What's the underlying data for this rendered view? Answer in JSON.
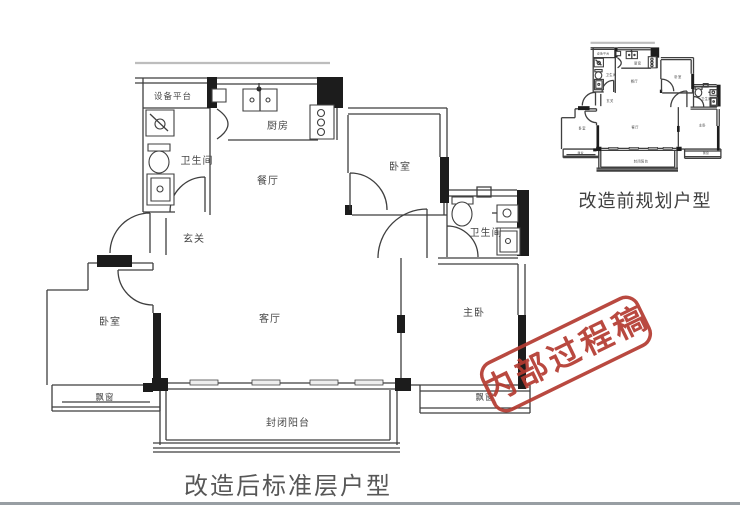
{
  "page": {
    "background": "#ffffff"
  },
  "plan_main": {
    "caption": "改造后标准层户型",
    "rooms": {
      "equipment_platform": "设备平台",
      "bathroom_1": "卫生间",
      "kitchen": "厨房",
      "dining": "餐厅",
      "bedroom_top": "卧室",
      "entrance": "玄关",
      "living": "客厅",
      "bedroom_left": "卧室",
      "master_bedroom": "主卧",
      "bathroom_2": "卫生间",
      "bay_window_left": "飘窗",
      "bay_window_right": "飘窗",
      "balcony": "封闭阳台"
    }
  },
  "plan_mini": {
    "caption": "改造前规划户型"
  },
  "stamp": {
    "text": "内部过程稿",
    "color": "#b43a30"
  },
  "colors": {
    "wall_line": "#3f3f3f",
    "wall_fill": "#1c1c1c",
    "label_text": "#474747",
    "caption_text": "#575757",
    "divider": "#989ea3"
  }
}
